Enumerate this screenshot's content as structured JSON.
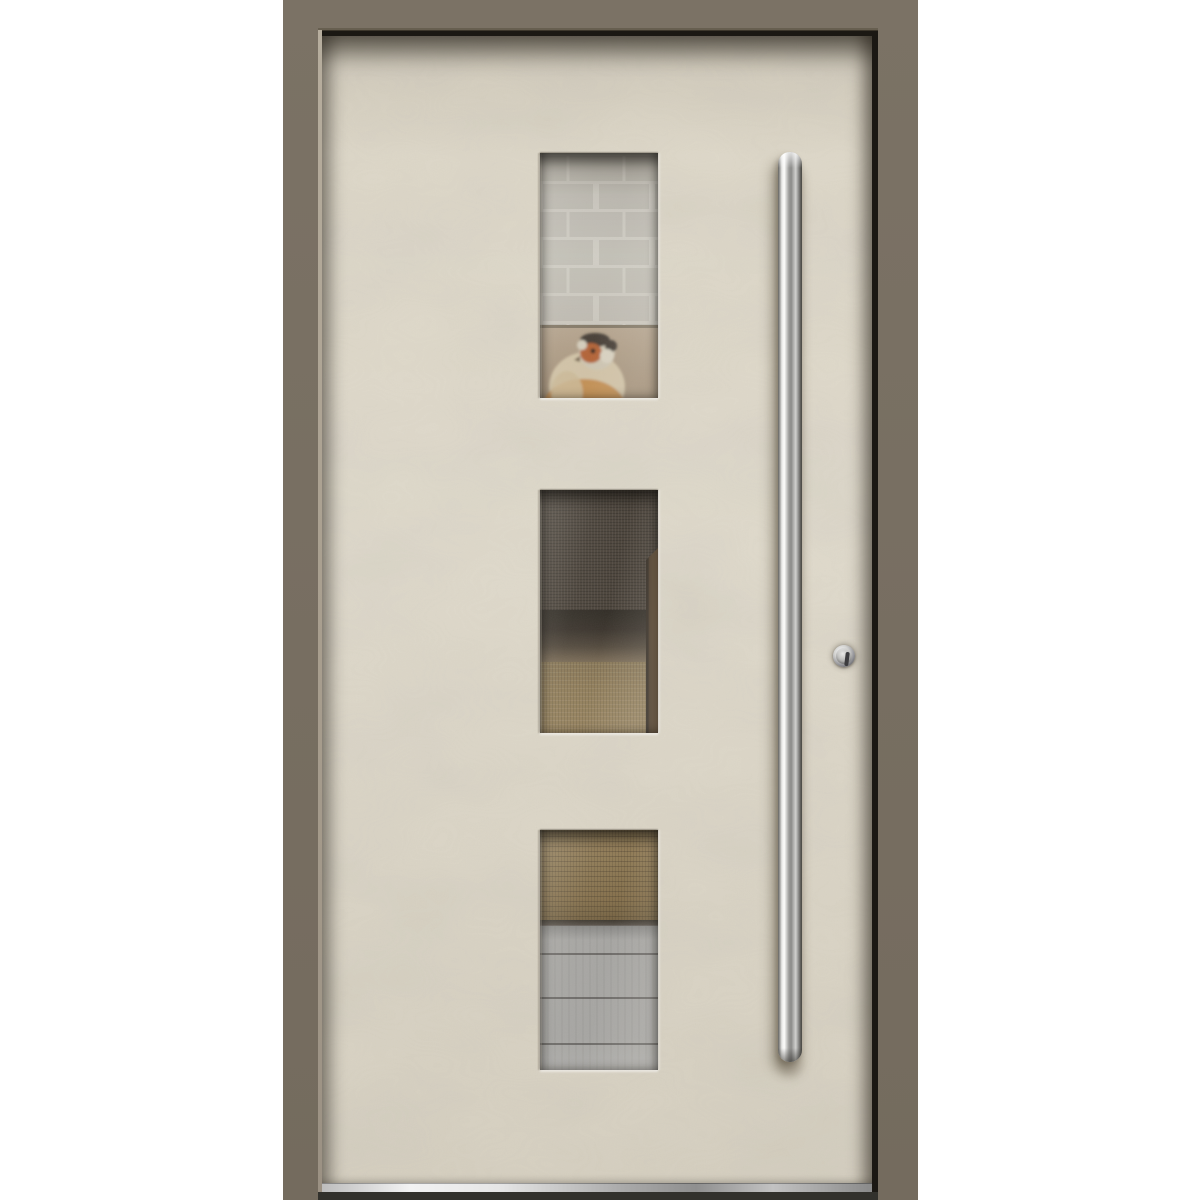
{
  "meta": {
    "type": "product-photo",
    "subject": "Modern front entry door: cream textured leaf in a taupe frame, three vertical glass panels, long stainless-steel bar handle and round cylinder lock"
  },
  "colors": {
    "background": "#ffffff",
    "frame": "#7b7265",
    "frameEdgeLight": "#aca18f",
    "frameEdgeDark": "#2a2620",
    "leaf": "#ded8c9",
    "brick": "#c6c3bb",
    "mortar": "#d6d3cb",
    "cushion": "#ae9b83",
    "fabric": "#3d352c",
    "carpetMid": "#8d7852",
    "carpetBottom": "#7d663f",
    "wood": "#5a452e",
    "floor": "#a2a19f",
    "steel": "#c9c9c7",
    "thresholdDark": "#32312c",
    "birdFace": "#b05a2a",
    "birdCap": "#3a332b",
    "birdBody": "#d2c2a4"
  },
  "door": {
    "glass_panels": [
      {
        "position": "top",
        "view": "white painted brick wall with a plush goldfinch bird resting on a cushion"
      },
      {
        "position": "middle",
        "view": "dark brown upholstery fabric above a tan carpet, wooden door edge at right"
      },
      {
        "position": "bottom",
        "view": "tan woven carpet meeting grey wooden floorboards"
      }
    ],
    "hardware": {
      "handle": "vertical stainless-steel pull bar",
      "lock": "round cylinder keyhole",
      "threshold": "aluminium threshold strip"
    }
  }
}
